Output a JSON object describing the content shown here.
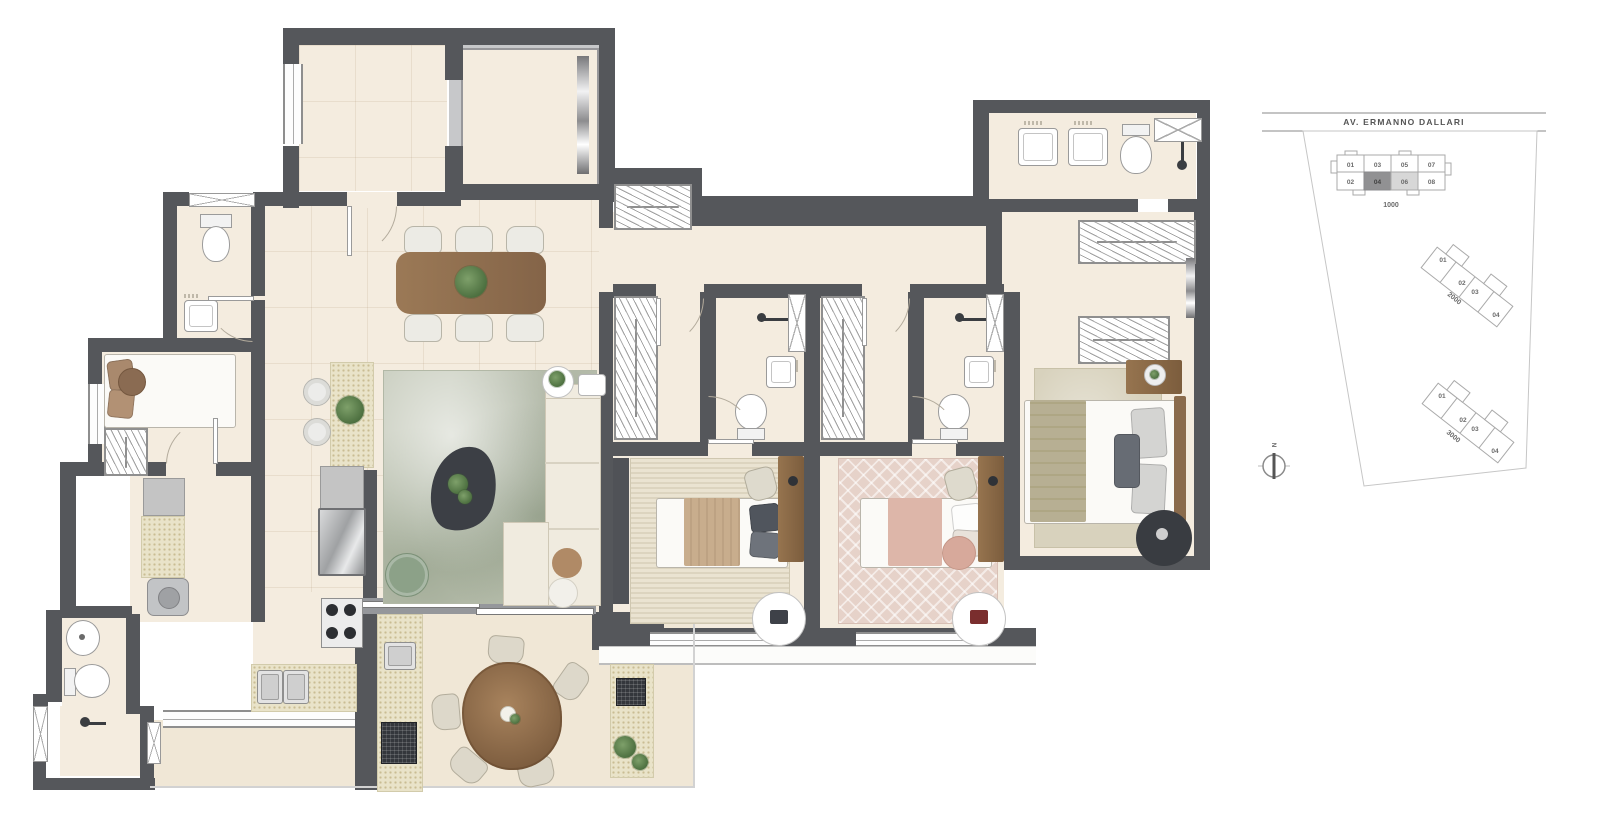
{
  "key_plan": {
    "street_label": "AV. ERMANNO DALLARI",
    "north_label": "N",
    "building_1000": {
      "label": "1000",
      "top_units": [
        "01",
        "03",
        "05",
        "07"
      ],
      "bottom_units": [
        "02",
        "04",
        "06",
        "08"
      ],
      "selected_unit": "04",
      "secondary_unit": "06"
    },
    "building_2000": {
      "label": "2000",
      "units": [
        "01",
        "02",
        "03",
        "04"
      ]
    },
    "building_3000": {
      "label": "3000",
      "units": [
        "01",
        "02",
        "03",
        "04"
      ]
    }
  },
  "palette": {
    "wall": "#55575b",
    "floor": "#f4ecdf",
    "floor_terrace": "#f0e7d6",
    "counter": "#e9e3c9",
    "rug_green_base": "#c3c8b8",
    "rug_pink_base": "#e6d2c9",
    "accent_green": "#8ca188",
    "wood": "#96744f",
    "dark_furniture": "#3c3f45",
    "keyplan_dark_cell": "#919193",
    "keyplan_light_cell": "#d7d7d7"
  }
}
